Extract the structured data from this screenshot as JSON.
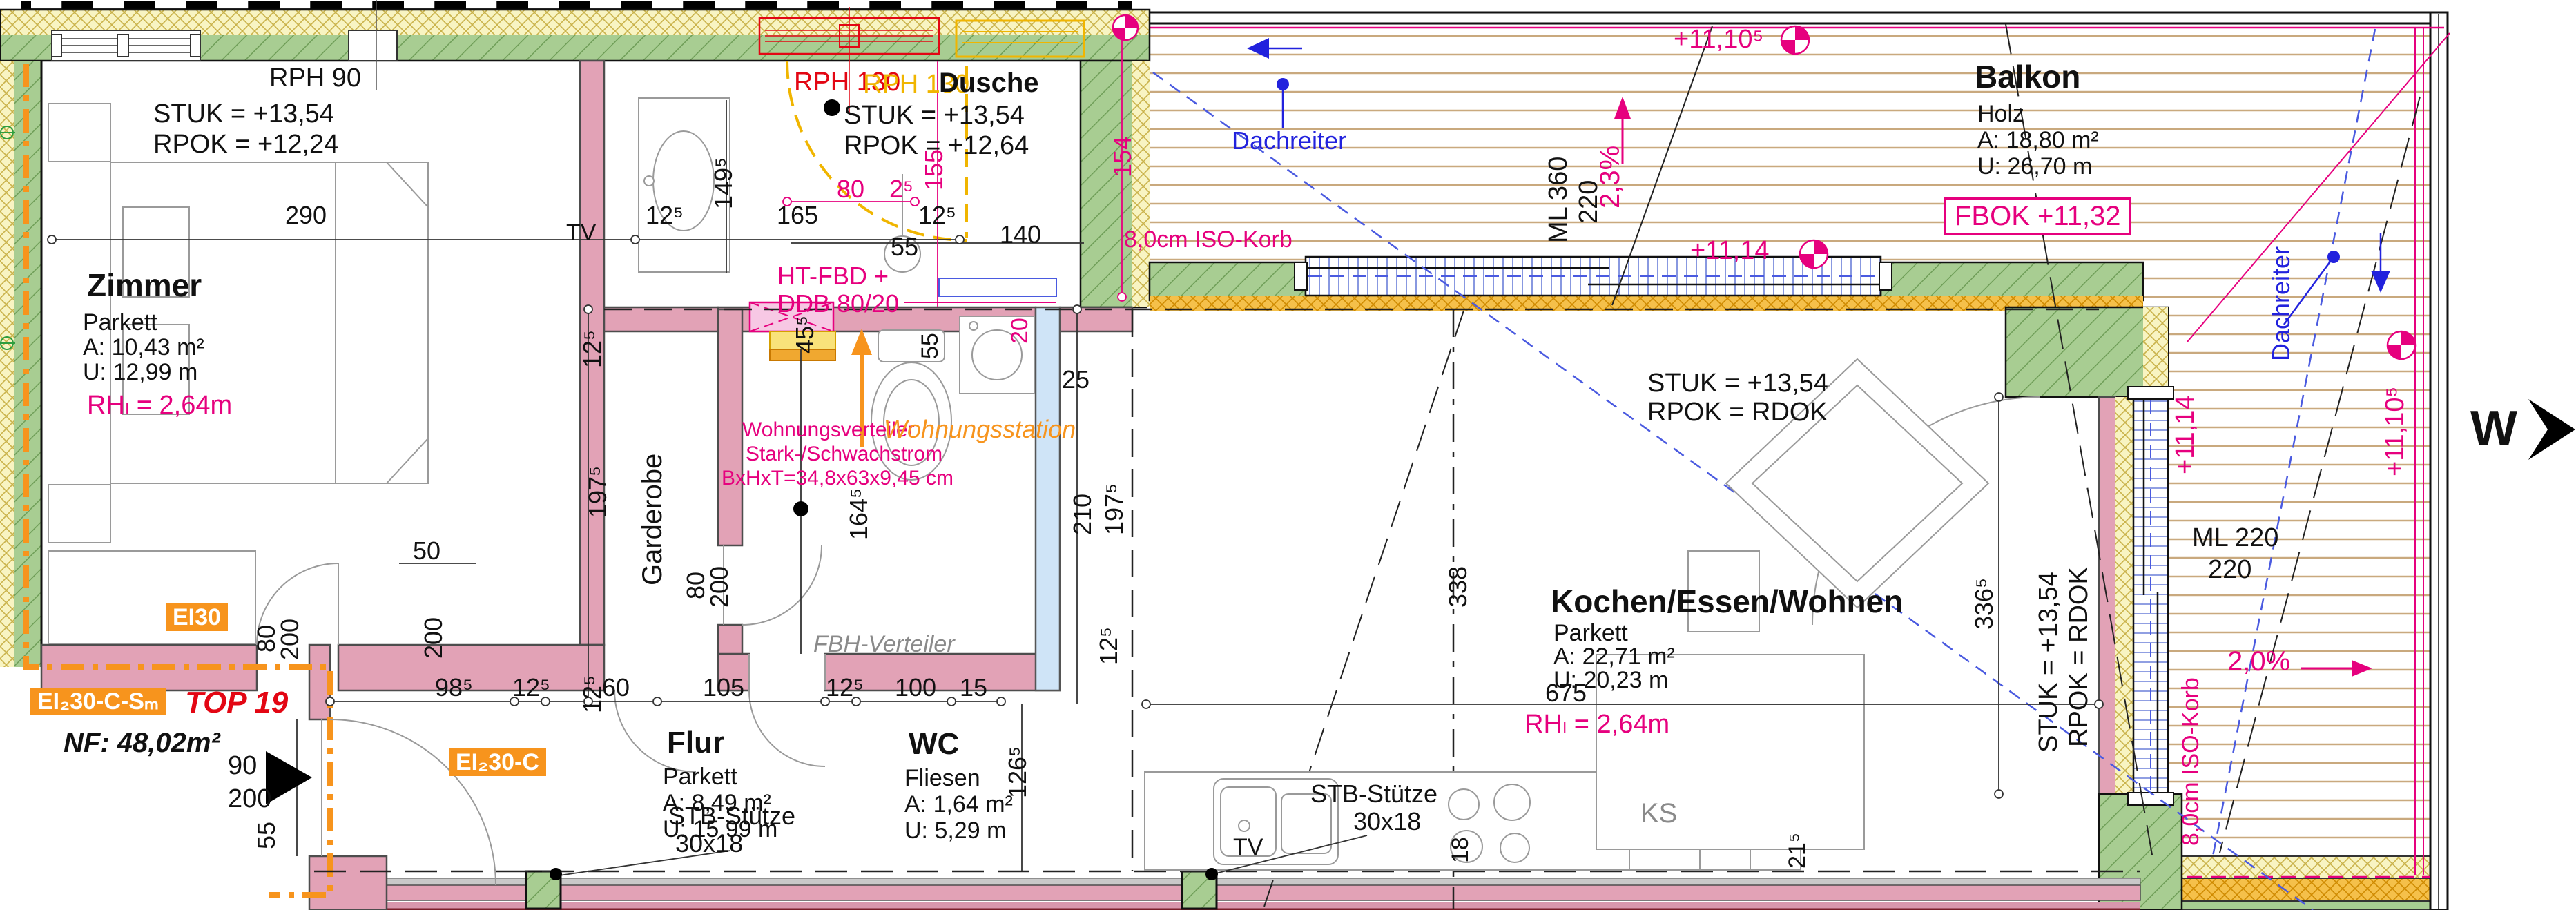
{
  "plan": {
    "unit_title": "TOP 19",
    "nf": "NF: 48,02m²",
    "ei30": "EI30",
    "ei230csm": "EI₂30-C-Sₘ",
    "ei230c": "EI₂30-C"
  },
  "rooms": {
    "zimmer": {
      "name": "Zimmer",
      "floor": "Parkett",
      "area": "A: 10,43 m²",
      "perimeter": "U: 12,99 m"
    },
    "dusche": {
      "name": "Dusche"
    },
    "garderobe": {
      "name": "Garderobe"
    },
    "flur": {
      "name": "Flur",
      "floor": "Parkett",
      "area": "A:  8,49 m²",
      "perimeter": "U: 15,99 m"
    },
    "wc": {
      "name": "WC",
      "floor": "Fliesen",
      "area": "A:  1,64 m²",
      "perimeter": "U:  5,29 m"
    },
    "kochen": {
      "name": "Kochen/Essen/Wohnen",
      "floor": "Parkett",
      "area": "A: 22,71 m²",
      "perimeter": "U: 20,23 m"
    },
    "balkon": {
      "name": "Balkon",
      "floor": "Holz",
      "area": "A: 18,80 m²",
      "perimeter": "U: 26,70 m"
    }
  },
  "ann": {
    "rph90": "RPH 90",
    "rph130": "RPH 130",
    "stuk1354": "STUK = +13,54",
    "rpok1224": "RPOK = +12,24",
    "rpok1264": "RPOK = +12,64",
    "rpok_rdok": "RPOK = RDOK",
    "rh": "RHₗ = 2,64m",
    "ht_fbd": "HT-FBD +",
    "ddb": "DDB 80/20",
    "wv1": "Wohnungsverteiler",
    "wv2": "Stark-/Schwachstrom",
    "wv3": "BxHxT=34,8x63x9,45 cm",
    "wohnungsstation": "Wohnungsstation",
    "fbh": "FBH-Verteiler",
    "dachreiter": "Dachreiter",
    "iso_korb": "8,0cm ISO-Korb",
    "slope23": "2,3%",
    "slope20": "2,0%",
    "lvl_1110_5": "+11,10⁵",
    "lvl_1114": "+11,14",
    "fbok": "FBOK +11,32",
    "ml360_1": "ML 360",
    "ml360_2": "220",
    "ml220_1": "ML 220",
    "ml220_2": "220",
    "stb1": "STB-Stütze",
    "stb2": "30x18",
    "ks": "KS",
    "tv": "TV",
    "compass_w": "W"
  },
  "dims": {
    "d290": "290",
    "d165": "165",
    "d125": "12⁵",
    "d149_5": "149⁵",
    "d55": "55",
    "d80": "80",
    "d200": "200",
    "d2_5": "2⁵",
    "d140": "140",
    "d155": "155",
    "d154": "154",
    "d20": "20",
    "d25": "25",
    "d45_5": "45⁵",
    "d210": "210",
    "d197_5": "197⁵",
    "d164_5": "164⁵",
    "d50": "50",
    "d90": "90",
    "d98_5": "98⁵",
    "d60": "60",
    "d105": "105",
    "d100": "100",
    "d15": "15",
    "d126_5": "126⁵",
    "d338": "338",
    "d675": "675",
    "d336_5": "336⁵",
    "d21_5": "21⁵",
    "d18": "18"
  }
}
